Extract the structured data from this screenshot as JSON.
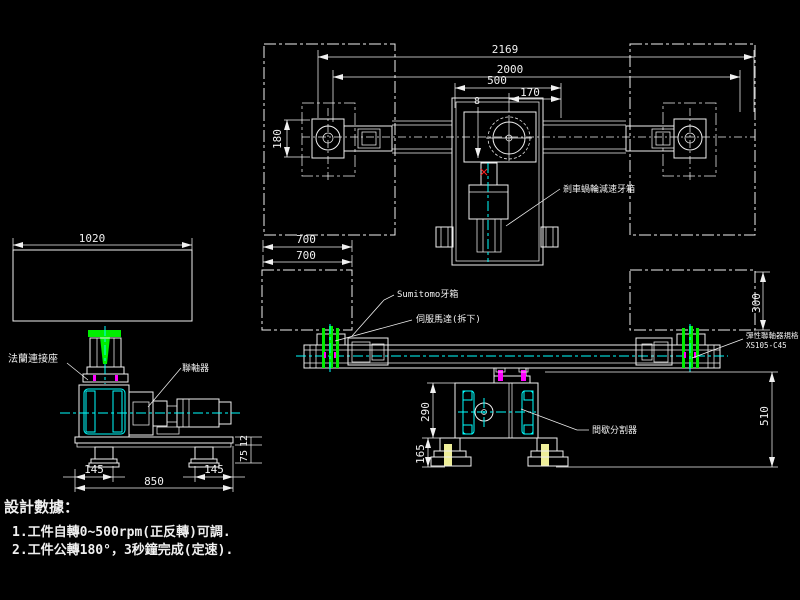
{
  "colors": {
    "background": "#000000",
    "line": "#f0f0f0",
    "centerline": "#00ffff",
    "clamp_green": "#00ee00",
    "fitting_magenta": "#ff00ff",
    "anchor_bolt_yellow": "#eeee99",
    "marker_red": "#ff2222"
  },
  "top_view": {
    "dims": {
      "overall": "2169",
      "between_spindles": "2000",
      "to_center": "500",
      "offset": "170",
      "spindle_height": "180",
      "bolt_callout": "8",
      "col_width_a": "700",
      "col_width_b": "700"
    },
    "labels": {
      "gearbox": "剎車蝸輪減速牙箱"
    }
  },
  "front_view": {
    "dims": {
      "column": "300",
      "height": "510"
    },
    "labels": {
      "sumitomo": "Sumitomo牙箱",
      "servo": "伺服馬達(拆下)",
      "spec_line1": "彈性聯軸器規格",
      "spec_line2": "XS105-C45",
      "indexer": "間歇分割器"
    }
  },
  "indexer_view": {
    "dims": {
      "body": "290",
      "base": "165"
    }
  },
  "side_view": {
    "dims": {
      "table_width": "1020",
      "left_offset": "145",
      "base_width": "850",
      "right_offset": "145",
      "pad_height": "75",
      "shim": "12"
    },
    "labels": {
      "flange": "法蘭連接座",
      "coupling": "聯軸器"
    }
  },
  "notes": {
    "title": "設計數據：",
    "item1": "1.工件自轉0~500rpm(正反轉)可調.",
    "item2": "2.工件公轉180°，3秒鐘完成(定速)."
  }
}
